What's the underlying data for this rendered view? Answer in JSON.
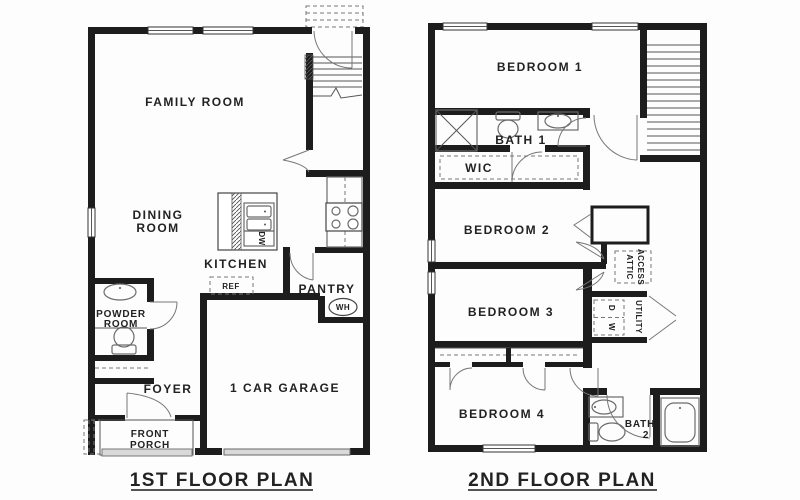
{
  "colors": {
    "wall": "#1d1d1d",
    "background": "#fdfdfd",
    "fixture_line": "#6b6b6b",
    "slab": "#d9d9d9"
  },
  "f1": {
    "title": "1ST FLOOR PLAN",
    "family_room": "FAMILY ROOM",
    "dining_l1": "DINING",
    "dining_l2": "ROOM",
    "kitchen": "KITCHEN",
    "pantry": "PANTRY",
    "ref": "REF",
    "wh": "WH",
    "dw": "DW",
    "powder_l1": "POWDER",
    "powder_l2": "ROOM",
    "foyer": "FOYER",
    "garage": "1 CAR GARAGE",
    "porch_l1": "FRONT",
    "porch_l2": "PORCH"
  },
  "f2": {
    "title": "2ND FLOOR PLAN",
    "bedroom1": "BEDROOM 1",
    "bedroom2": "BEDROOM 2",
    "bedroom3": "BEDROOM 3",
    "bedroom4": "BEDROOM 4",
    "bath1": "BATH 1",
    "bath2_l1": "BATH",
    "bath2_l2": "2",
    "wic": "WIC",
    "attic_l1": "ATTIC",
    "attic_l2": "ACCESS",
    "utility": "UTILITY",
    "washer": "W",
    "dryer": "D"
  }
}
